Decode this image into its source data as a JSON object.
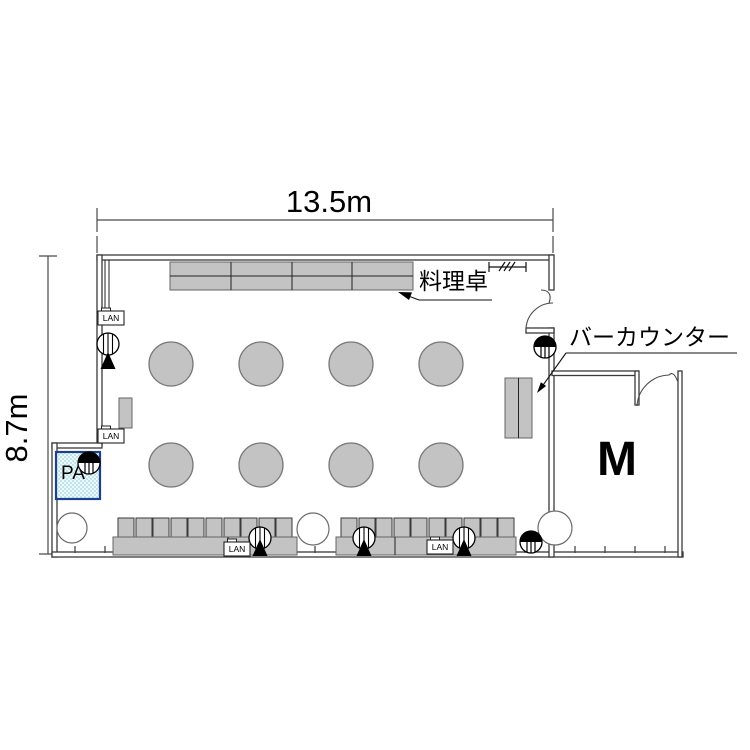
{
  "title": "宴会場平面図 (banquet hall floor plan)",
  "dimensions": {
    "width": "13.5m",
    "height": "8.7m"
  },
  "labels": {
    "food_table": "料理卓",
    "bar_counter": "バーカウンター",
    "monitor_room": "M",
    "pa": "PA",
    "lan": "LAN"
  },
  "furniture": {
    "buffet_table_sections": 4,
    "round_tables": 8,
    "round_table_layout": "2 rows x 4 columns",
    "chair_rows": 2,
    "chairs_per_row": 10,
    "banquet_tables": 2,
    "bar_counter_units": 2,
    "lan_ports": 4,
    "ceiling_speakers": 3,
    "floor_stands": 4,
    "pillars": 3
  },
  "colors": {
    "background": "#ffffff",
    "wall_line": "#3a3a3a",
    "furniture_fill": "#c3c3c3",
    "furniture_stroke": "#666666",
    "pa_box_border": "#1d3f8e",
    "pa_box_fill": "#d2ecf1",
    "annotation_text": "#000000"
  }
}
